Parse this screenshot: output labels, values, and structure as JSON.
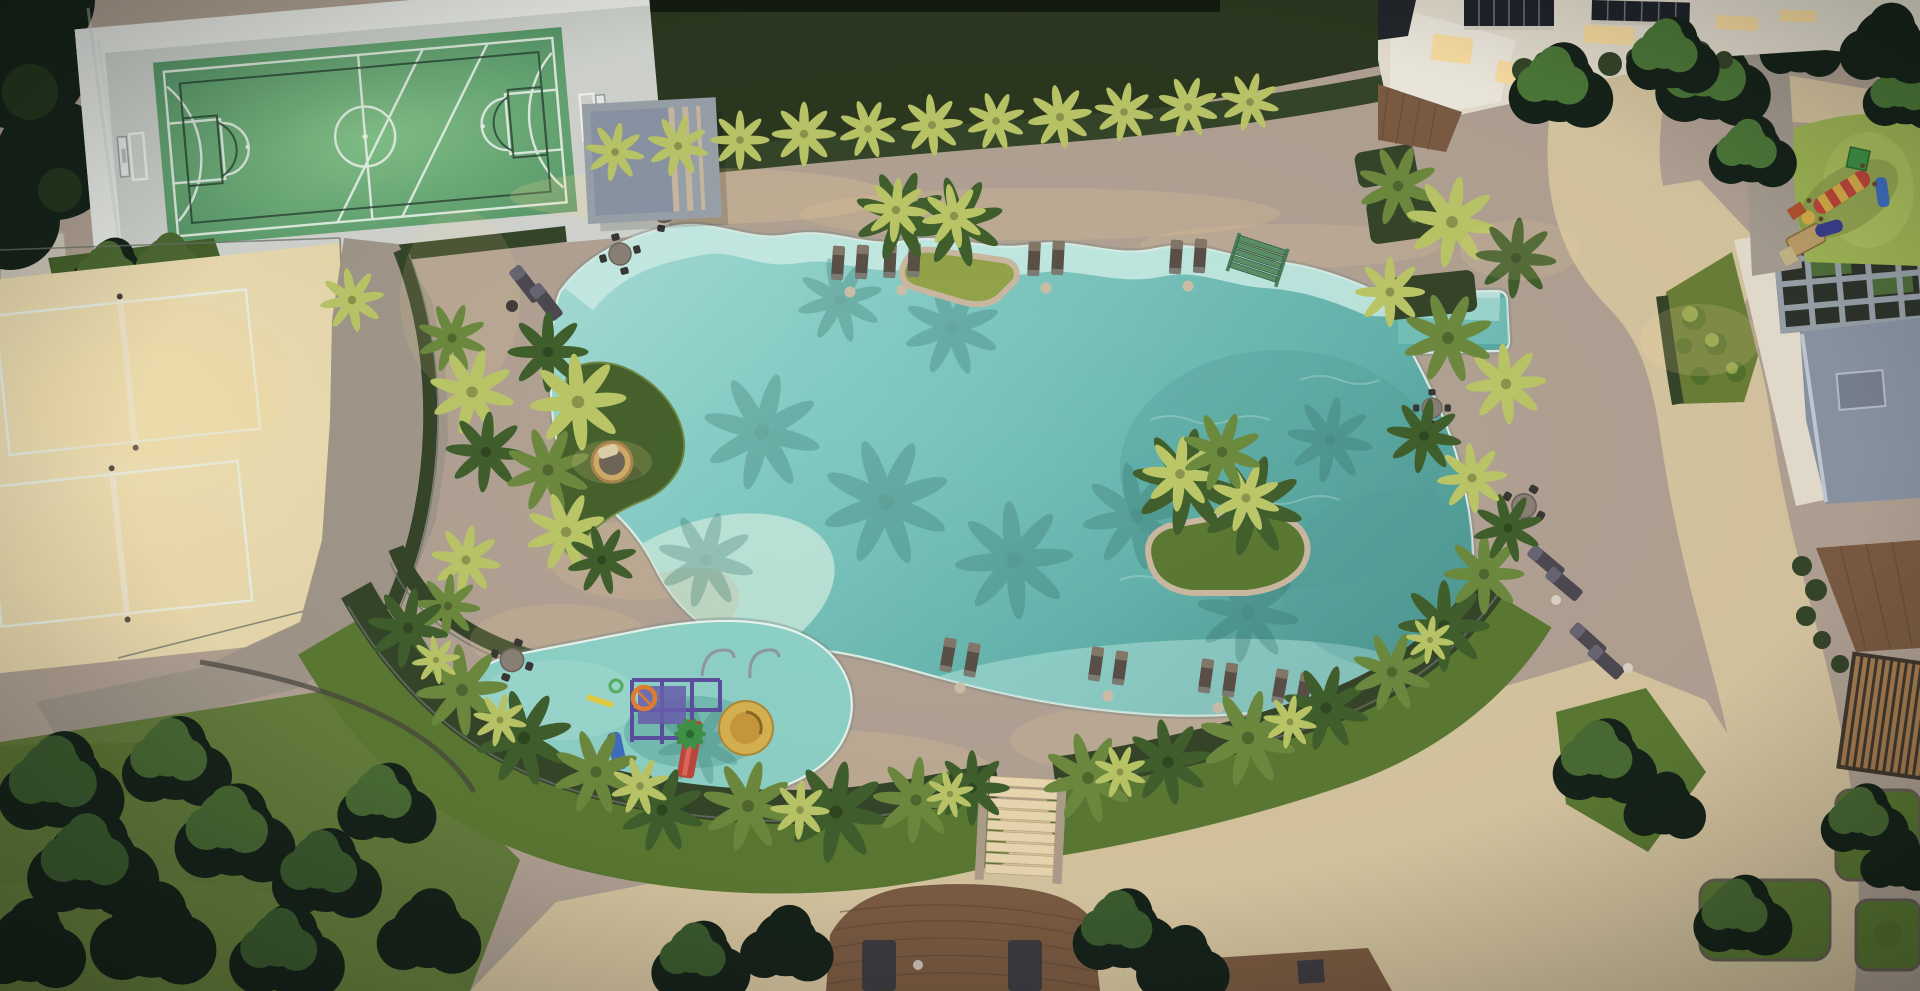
{
  "scene": {
    "title": "Aerial dusk rendering of a resort-style residential leisure deck with lagoon pool",
    "view": "top-down aerial",
    "time_of_day": "dusk",
    "amenities": [
      {
        "id": "multisport-court",
        "label": "Multi-sport court"
      },
      {
        "id": "beach-volleyball",
        "label": "Beach volleyball courts"
      },
      {
        "id": "lagoon-pool",
        "label": "Lagoon-style pool"
      },
      {
        "id": "tanning-ledge",
        "label": "In-water tanning ledge with loungers"
      },
      {
        "id": "palm-islands",
        "label": "Palm islands"
      },
      {
        "id": "kids-splash-pool",
        "label": "Kids splash pool"
      },
      {
        "id": "water-play-structure",
        "label": "Water play structure"
      },
      {
        "id": "pergola-cabana",
        "label": "Pergola cabana"
      },
      {
        "id": "round-daybed",
        "label": "Round rattan daybed"
      },
      {
        "id": "sun-loungers",
        "label": "Sun loungers"
      },
      {
        "id": "dining-sets",
        "label": "Outdoor dining sets"
      },
      {
        "id": "kids-playground",
        "label": "Kids playground"
      },
      {
        "id": "wood-deck-lounge",
        "label": "Timber lounge deck"
      },
      {
        "id": "garden-paths",
        "label": "Garden paths"
      },
      {
        "id": "residential-building",
        "label": "Residential building edge"
      }
    ]
  },
  "palette": {
    "deck-stone": "#b3a395",
    "deck-stone-lit": "#cbb9a2",
    "cool-stone": "#a2988b",
    "path-beige": "#d9c7a2",
    "path-beige-lit": "#ecdab2",
    "sand": "#e7d6a9",
    "sand-lit": "#f4e6bb",
    "lawn-dark": "#2c3820",
    "hedge-dark": "#36462a",
    "grass-mid": "#5c7a33",
    "grass-dark": "#46622c",
    "grass-lit": "#8aa348",
    "palm-dark": "#41602d",
    "palm-mid": "#6d8b3f",
    "palm-lit": "#bcc868",
    "shadow-teal": "#2f6b63",
    "water-shallow": "#abe0d8",
    "water-mid": "#84cdc5",
    "water-deep": "#63b3ac",
    "water-deep2": "#539e98",
    "water-pale": "#cdeee7",
    "kids-water": "#8fd3c9",
    "pool-rim": "#eaf6f0",
    "steps-green": "#5c8f68",
    "line-white": "#edf4ec",
    "line-dark": "#2a4433",
    "court-green": "#559668",
    "court-green-lit": "#85c48b",
    "apron": "#d3d6d1",
    "apron-wall": "#eceeea",
    "fence": "#6f746a",
    "wood": "#7d5c43",
    "wood-dark": "#5d4430",
    "wood-light": "#a97f52",
    "building-cream": "#e8e1d2",
    "building-white": "#f1ece1",
    "pergola-gray": "#9aa2ab",
    "gravel": "#8b95a5",
    "glow-warm": "#ffdf9d",
    "lounger": "#5a5048",
    "lounger-light": "#847868",
    "lounger-gray": "#4e4a52",
    "furniture-dark": "#3a3835",
    "table-top": "#8b8177",
    "play-purple": "#5b4fa0",
    "play-red": "#c1473c",
    "play-yellow": "#d9af4a",
    "play-green": "#3f9347",
    "play-orange": "#e28030",
    "play-blue": "#3f6fc1",
    "rubber-green": "#a2b857",
    "dark-trees": "#16231a",
    "balcony-dark": "#20242a"
  }
}
